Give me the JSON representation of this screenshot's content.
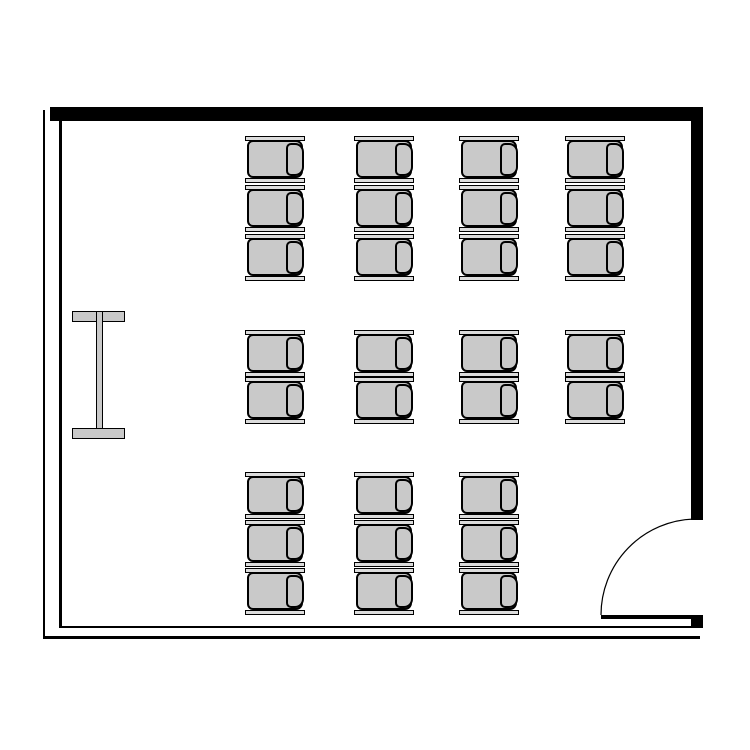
{
  "name": "classroom-floor-plan",
  "canvas": {
    "width": 750,
    "height": 750,
    "background": "#ffffff"
  },
  "colors": {
    "wall": "#000000",
    "outline": "#000000",
    "seat_fill": "#c9c9c9",
    "bar_fill": "#dcdcdc"
  },
  "walls": [
    {
      "name": "wall-top",
      "x": 50,
      "y": 107,
      "w": 653,
      "h": 14
    },
    {
      "name": "wall-right",
      "x": 691,
      "y": 107,
      "w": 12,
      "h": 413
    },
    {
      "name": "wall-left-outer",
      "x": 43,
      "y": 110,
      "w": 2,
      "h": 529
    },
    {
      "name": "wall-left-inner",
      "x": 59,
      "y": 121,
      "w": 3,
      "h": 505
    },
    {
      "name": "wall-bottom-inner",
      "x": 59,
      "y": 626,
      "w": 640,
      "h": 2
    },
    {
      "name": "wall-bottom-outer",
      "x": 43,
      "y": 636,
      "w": 657,
      "h": 3
    }
  ],
  "door": {
    "box": {
      "x": 601,
      "y": 519,
      "w": 102,
      "h": 109
    },
    "leaf": {
      "x": 0,
      "y": 96,
      "w": 96,
      "h": 4
    },
    "hinge": {
      "x": 90,
      "y": 96,
      "w": 12,
      "h": 13
    },
    "arc": {
      "path": "M 601 615 A 96 96 0 0 1 694 519",
      "stroke_width": 1.2
    }
  },
  "lectern": {
    "box": {
      "x": 72,
      "y": 311,
      "w": 53,
      "h": 128
    },
    "parts": [
      {
        "name": "lectern-top-flange",
        "x": 0,
        "y": 0,
        "w": 53,
        "h": 11
      },
      {
        "name": "lectern-web",
        "x": 24,
        "y": 0,
        "w": 7,
        "h": 128
      },
      {
        "name": "lectern-bottom-flange",
        "x": 0,
        "y": 117,
        "w": 53,
        "h": 11
      }
    ]
  },
  "chairs": {
    "facing": "left",
    "count": 29,
    "unit": {
      "w": 60,
      "h": 47,
      "bar_h": 5,
      "seat": {
        "dx": 2,
        "dy": 4,
        "w": 56,
        "h": 38
      },
      "backrest": {
        "dx": 41,
        "dy": 7,
        "w": 18,
        "h": 33
      }
    },
    "columns_x": [
      245,
      354,
      459,
      565
    ],
    "groups": [
      {
        "name": "chair-block-top",
        "y": 136,
        "rows": 3,
        "pitch": 49,
        "columns": [
          0,
          1,
          2,
          3
        ]
      },
      {
        "name": "chair-block-middle",
        "y": 330,
        "rows": 2,
        "pitch": 47,
        "columns": [
          0,
          1,
          2,
          3
        ]
      },
      {
        "name": "chair-block-bottom",
        "y": 472,
        "rows": 3,
        "pitch": 48,
        "columns": [
          0,
          1,
          2
        ]
      }
    ]
  }
}
